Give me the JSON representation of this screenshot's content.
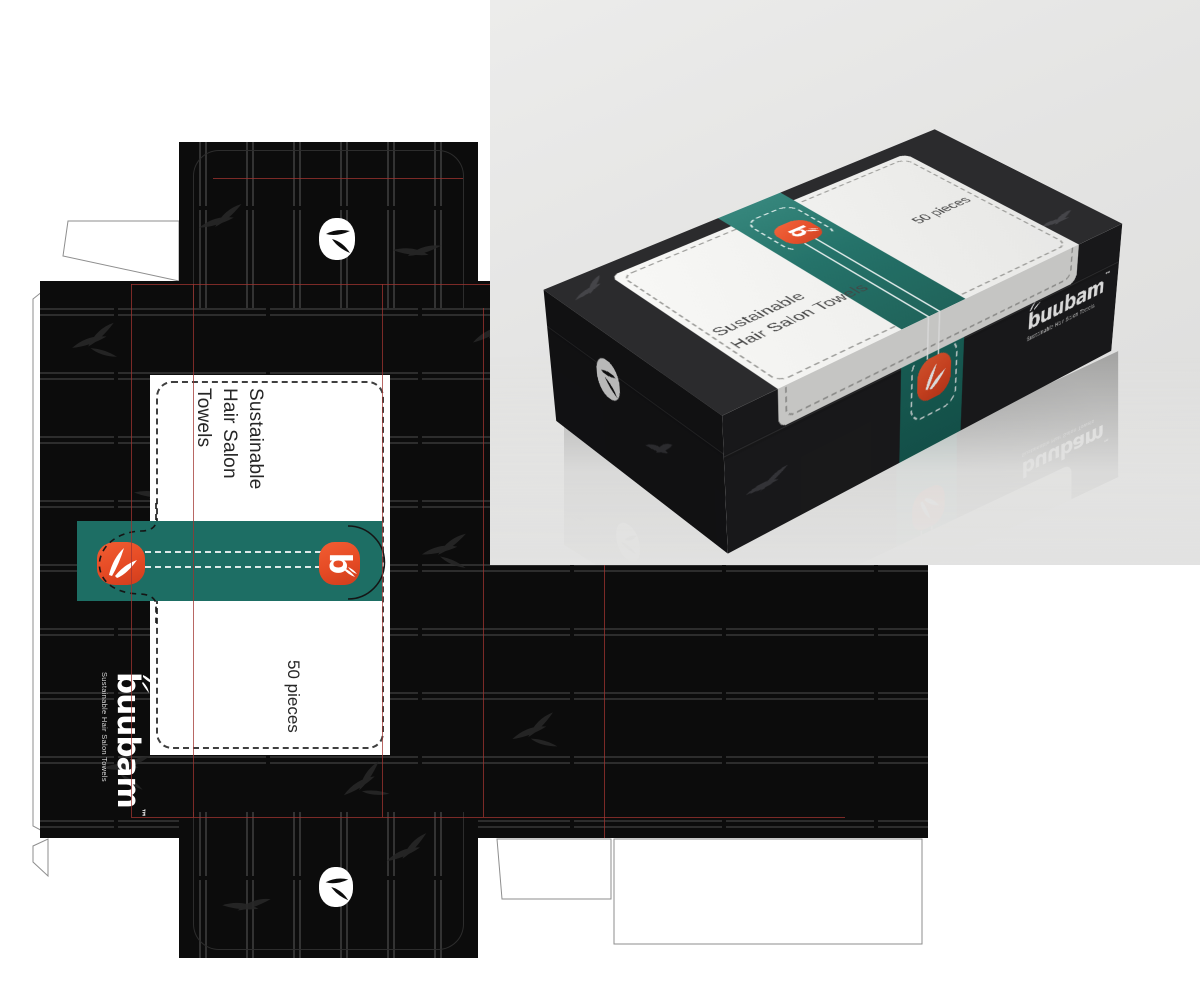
{
  "dieline": {
    "label_title": [
      "Sustainable",
      "Hair Salon Towels"
    ],
    "label_qty": "50 pieces",
    "brand": "buubam",
    "brand_tm": "™",
    "brand_tagline": "Sustainable Hair Salon Towels",
    "badge_letter": "b"
  },
  "box": {
    "top_title": [
      "Sustainable",
      "Hair Salon Towels"
    ],
    "top_qty": "50 pieces",
    "brand": "buubam",
    "brand_tm": "™",
    "brand_tagline": "Sustainable Hair Salon Towels",
    "badge_letter": "b"
  },
  "colors": {
    "teal": "#1d6e64",
    "teal_dark": "#175e55",
    "orange": "#e54a24",
    "orange_dark": "#cf3d1d",
    "panel": "#0c0c0c",
    "stalk": "#2d2d2d",
    "red": "#a03430",
    "gray_bg": "#e4e4e3"
  }
}
